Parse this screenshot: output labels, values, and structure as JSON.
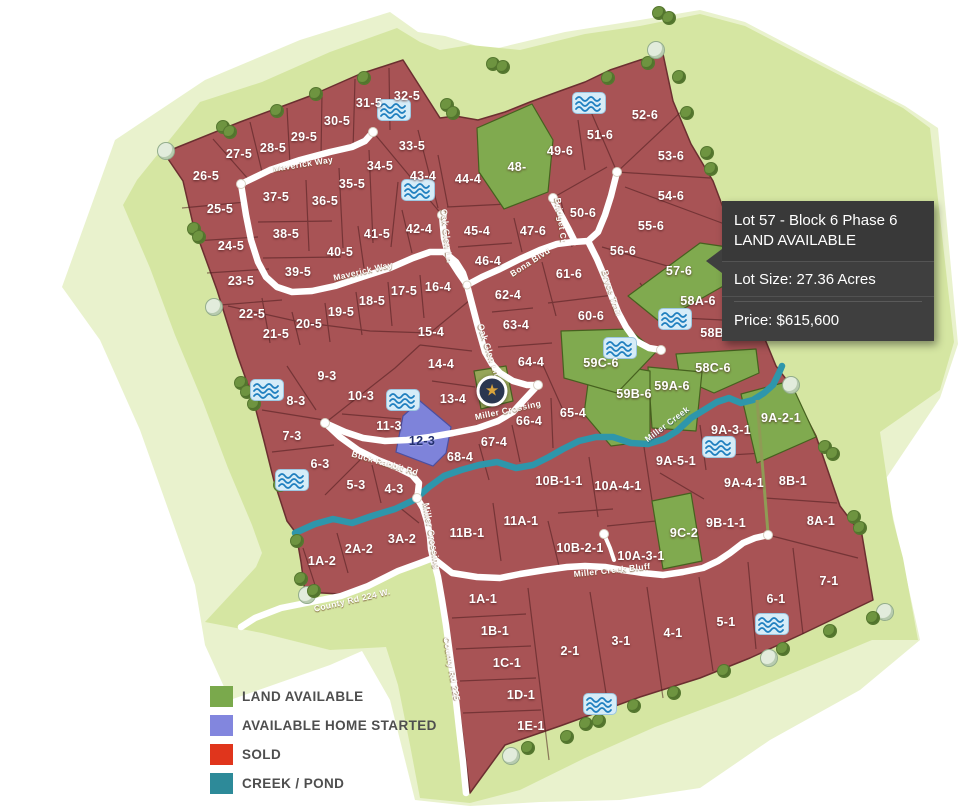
{
  "colors": {
    "sold": "#a85355",
    "available": "#80aa4f",
    "home_started": "#7e83da",
    "creek": "#2e96ab",
    "band_inner": "#d5e6a2",
    "band_outer": "#e9f2cd",
    "road": "#ffffff",
    "lot_border": "#5e2d2f",
    "legend_available": "#7aa94c",
    "legend_home_started": "#8286de",
    "legend_sold": "#e0351c",
    "legend_creek": "#2d8a99"
  },
  "tooltip": {
    "title": "Lot 57 - Block 6  Phase 6",
    "status": "LAND AVAILABLE",
    "lot_size": "Lot Size: 27.36 Acres",
    "price": "Price: $615,600"
  },
  "legend": {
    "items": [
      {
        "label": "LAND AVAILABLE",
        "color": "#7aa94c"
      },
      {
        "label": "AVAILABLE HOME STARTED",
        "color": "#8286de"
      },
      {
        "label": "SOLD",
        "color": "#e0351c"
      },
      {
        "label": "CREEK / POND",
        "color": "#2d8a99"
      }
    ]
  },
  "map": {
    "star": {
      "x": 492,
      "y": 391,
      "glyph": "★"
    },
    "creek_label": {
      "text": "Miller Creek",
      "x": 667,
      "y": 424,
      "angle": -37
    },
    "road_labels": [
      {
        "text": "Maverick Way",
        "x": 303,
        "y": 164,
        "angle": -9
      },
      {
        "text": "Maverick Way",
        "x": 363,
        "y": 271,
        "angle": -13
      },
      {
        "text": "Oak Glen Ln",
        "x": 447,
        "y": 236,
        "angle": 84
      },
      {
        "text": "Bona Blvd",
        "x": 530,
        "y": 262,
        "angle": -33
      },
      {
        "text": "Bridget Ct",
        "x": 561,
        "y": 220,
        "angle": 82
      },
      {
        "text": "Bryce Trail",
        "x": 612,
        "y": 293,
        "angle": 73
      },
      {
        "text": "Oak Glen Ln",
        "x": 489,
        "y": 350,
        "angle": 72
      },
      {
        "text": "Miller Crossing",
        "x": 508,
        "y": 410,
        "angle": -12
      },
      {
        "text": "Buck Rabbit Rd",
        "x": 385,
        "y": 463,
        "angle": 16
      },
      {
        "text": "Miller Crossing",
        "x": 432,
        "y": 536,
        "angle": 80
      },
      {
        "text": "Miller Creek Bluff",
        "x": 612,
        "y": 570,
        "angle": -6
      },
      {
        "text": "County Rd 224 W.",
        "x": 352,
        "y": 600,
        "angle": -13
      },
      {
        "text": "County Rd 225",
        "x": 452,
        "y": 669,
        "angle": 80
      }
    ],
    "ponds": [
      {
        "x": 394,
        "y": 110
      },
      {
        "x": 589,
        "y": 103
      },
      {
        "x": 418,
        "y": 190
      },
      {
        "x": 267,
        "y": 390
      },
      {
        "x": 403,
        "y": 400
      },
      {
        "x": 292,
        "y": 480
      },
      {
        "x": 675,
        "y": 319
      },
      {
        "x": 620,
        "y": 348
      },
      {
        "x": 719,
        "y": 447
      },
      {
        "x": 772,
        "y": 624
      },
      {
        "x": 600,
        "y": 704
      }
    ],
    "trees": [
      {
        "x": 165,
        "y": 150,
        "t": "pale"
      },
      {
        "x": 193,
        "y": 228,
        "t": "green"
      },
      {
        "x": 198,
        "y": 236,
        "t": "green"
      },
      {
        "x": 213,
        "y": 306,
        "t": "pale"
      },
      {
        "x": 240,
        "y": 382,
        "t": "green"
      },
      {
        "x": 246,
        "y": 391,
        "t": "green"
      },
      {
        "x": 253,
        "y": 403,
        "t": "green"
      },
      {
        "x": 279,
        "y": 484,
        "t": "green"
      },
      {
        "x": 296,
        "y": 540,
        "t": "green"
      },
      {
        "x": 300,
        "y": 578,
        "t": "green"
      },
      {
        "x": 306,
        "y": 594,
        "t": "pale"
      },
      {
        "x": 313,
        "y": 590,
        "t": "green"
      },
      {
        "x": 222,
        "y": 126,
        "t": "green"
      },
      {
        "x": 229,
        "y": 131,
        "t": "green"
      },
      {
        "x": 276,
        "y": 110,
        "t": "green"
      },
      {
        "x": 315,
        "y": 93,
        "t": "green"
      },
      {
        "x": 363,
        "y": 77,
        "t": "green"
      },
      {
        "x": 446,
        "y": 104,
        "t": "green"
      },
      {
        "x": 452,
        "y": 112,
        "t": "green"
      },
      {
        "x": 492,
        "y": 63,
        "t": "green"
      },
      {
        "x": 502,
        "y": 66,
        "t": "green"
      },
      {
        "x": 607,
        "y": 77,
        "t": "green"
      },
      {
        "x": 658,
        "y": 12,
        "t": "green"
      },
      {
        "x": 668,
        "y": 17,
        "t": "green"
      },
      {
        "x": 678,
        "y": 76,
        "t": "green"
      },
      {
        "x": 647,
        "y": 62,
        "t": "green"
      },
      {
        "x": 655,
        "y": 49,
        "t": "pale"
      },
      {
        "x": 686,
        "y": 112,
        "t": "green"
      },
      {
        "x": 706,
        "y": 152,
        "t": "green"
      },
      {
        "x": 710,
        "y": 168,
        "t": "green"
      },
      {
        "x": 824,
        "y": 446,
        "t": "green"
      },
      {
        "x": 832,
        "y": 453,
        "t": "green"
      },
      {
        "x": 853,
        "y": 516,
        "t": "green"
      },
      {
        "x": 859,
        "y": 527,
        "t": "green"
      },
      {
        "x": 790,
        "y": 384,
        "t": "pale"
      },
      {
        "x": 884,
        "y": 611,
        "t": "pale"
      },
      {
        "x": 872,
        "y": 617,
        "t": "green"
      },
      {
        "x": 829,
        "y": 630,
        "t": "green"
      },
      {
        "x": 768,
        "y": 657,
        "t": "pale"
      },
      {
        "x": 782,
        "y": 648,
        "t": "green"
      },
      {
        "x": 723,
        "y": 670,
        "t": "green"
      },
      {
        "x": 673,
        "y": 692,
        "t": "green"
      },
      {
        "x": 633,
        "y": 705,
        "t": "green"
      },
      {
        "x": 598,
        "y": 720,
        "t": "green"
      },
      {
        "x": 585,
        "y": 723,
        "t": "green"
      },
      {
        "x": 566,
        "y": 736,
        "t": "green"
      },
      {
        "x": 527,
        "y": 747,
        "t": "green"
      },
      {
        "x": 510,
        "y": 755,
        "t": "pale"
      }
    ],
    "lots": [
      {
        "id": "26-5",
        "x": 206,
        "y": 176,
        "status": "sold"
      },
      {
        "id": "27-5",
        "x": 239,
        "y": 154,
        "status": "sold"
      },
      {
        "id": "28-5",
        "x": 273,
        "y": 148,
        "status": "sold"
      },
      {
        "id": "29-5",
        "x": 304,
        "y": 137,
        "status": "sold"
      },
      {
        "id": "30-5",
        "x": 337,
        "y": 121,
        "status": "sold"
      },
      {
        "id": "31-5",
        "x": 369,
        "y": 103,
        "status": "sold"
      },
      {
        "id": "32-5",
        "x": 407,
        "y": 96,
        "status": "sold"
      },
      {
        "id": "33-5",
        "x": 412,
        "y": 146,
        "status": "sold"
      },
      {
        "id": "34-5",
        "x": 380,
        "y": 166,
        "status": "sold"
      },
      {
        "id": "35-5",
        "x": 352,
        "y": 184,
        "status": "sold"
      },
      {
        "id": "36-5",
        "x": 325,
        "y": 201,
        "status": "sold"
      },
      {
        "id": "37-5",
        "x": 276,
        "y": 197,
        "status": "sold"
      },
      {
        "id": "38-5",
        "x": 286,
        "y": 234,
        "status": "sold"
      },
      {
        "id": "39-5",
        "x": 298,
        "y": 272,
        "status": "sold"
      },
      {
        "id": "40-5",
        "x": 340,
        "y": 252,
        "status": "sold"
      },
      {
        "id": "41-5",
        "x": 377,
        "y": 234,
        "status": "sold"
      },
      {
        "id": "25-5",
        "x": 220,
        "y": 209,
        "status": "sold"
      },
      {
        "id": "24-5",
        "x": 231,
        "y": 246,
        "status": "sold"
      },
      {
        "id": "23-5",
        "x": 241,
        "y": 281,
        "status": "sold"
      },
      {
        "id": "22-5",
        "x": 252,
        "y": 314,
        "status": "sold"
      },
      {
        "id": "21-5",
        "x": 276,
        "y": 334,
        "status": "sold"
      },
      {
        "id": "20-5",
        "x": 309,
        "y": 324,
        "status": "sold"
      },
      {
        "id": "19-5",
        "x": 341,
        "y": 312,
        "status": "sold"
      },
      {
        "id": "18-5",
        "x": 372,
        "y": 301,
        "status": "sold"
      },
      {
        "id": "17-5",
        "x": 404,
        "y": 291,
        "status": "sold"
      },
      {
        "id": "42-4",
        "x": 419,
        "y": 229,
        "status": "sold"
      },
      {
        "id": "43-4",
        "x": 423,
        "y": 176,
        "status": "sold"
      },
      {
        "id": "44-4",
        "x": 468,
        "y": 179,
        "status": "sold"
      },
      {
        "id": "45-4",
        "x": 477,
        "y": 231,
        "status": "sold"
      },
      {
        "id": "46-4",
        "x": 488,
        "y": 261,
        "status": "sold"
      },
      {
        "id": "16-4",
        "x": 438,
        "y": 287,
        "status": "sold"
      },
      {
        "id": "62-4",
        "x": 508,
        "y": 295,
        "status": "sold"
      },
      {
        "id": "63-4",
        "x": 516,
        "y": 325,
        "status": "sold"
      },
      {
        "id": "64-4",
        "x": 531,
        "y": 362,
        "status": "sold"
      },
      {
        "id": "15-4",
        "x": 431,
        "y": 332,
        "status": "sold"
      },
      {
        "id": "14-4",
        "x": 441,
        "y": 364,
        "status": "sold"
      },
      {
        "id": "13-4",
        "x": 453,
        "y": 399,
        "status": "sold"
      },
      {
        "id": "65-4",
        "x": 573,
        "y": 413,
        "status": "sold"
      },
      {
        "id": "66-4",
        "x": 529,
        "y": 421,
        "status": "sold"
      },
      {
        "id": "67-4",
        "x": 494,
        "y": 442,
        "status": "sold"
      },
      {
        "id": "68-4",
        "x": 460,
        "y": 457,
        "status": "sold"
      },
      {
        "id": "47-6",
        "x": 533,
        "y": 231,
        "status": "sold"
      },
      {
        "id": "48-",
        "x": 517,
        "y": 167,
        "status": "available"
      },
      {
        "id": "49-6",
        "x": 560,
        "y": 151,
        "status": "sold"
      },
      {
        "id": "50-6",
        "x": 583,
        "y": 213,
        "status": "sold"
      },
      {
        "id": "51-6",
        "x": 600,
        "y": 135,
        "status": "sold"
      },
      {
        "id": "52-6",
        "x": 645,
        "y": 115,
        "status": "sold"
      },
      {
        "id": "53-6",
        "x": 671,
        "y": 156,
        "status": "sold"
      },
      {
        "id": "54-6",
        "x": 671,
        "y": 196,
        "status": "sold"
      },
      {
        "id": "55-6",
        "x": 651,
        "y": 226,
        "status": "sold"
      },
      {
        "id": "56-6",
        "x": 623,
        "y": 251,
        "status": "sold"
      },
      {
        "id": "57-6",
        "x": 679,
        "y": 271,
        "status": "available"
      },
      {
        "id": "58A-6",
        "x": 698,
        "y": 301,
        "status": "sold"
      },
      {
        "id": "58B-6",
        "x": 718,
        "y": 333,
        "status": "sold"
      },
      {
        "id": "58C-6",
        "x": 713,
        "y": 368,
        "status": "available"
      },
      {
        "id": "59A-6",
        "x": 672,
        "y": 386,
        "status": "available"
      },
      {
        "id": "59B-6",
        "x": 634,
        "y": 394,
        "status": "available"
      },
      {
        "id": "59C-6",
        "x": 601,
        "y": 363,
        "status": "available"
      },
      {
        "id": "60-6",
        "x": 591,
        "y": 316,
        "status": "sold"
      },
      {
        "id": "61-6",
        "x": 569,
        "y": 274,
        "status": "sold"
      },
      {
        "id": "9-3",
        "x": 327,
        "y": 376,
        "status": "sold"
      },
      {
        "id": "10-3",
        "x": 361,
        "y": 396,
        "status": "sold"
      },
      {
        "id": "8-3",
        "x": 296,
        "y": 401,
        "status": "sold"
      },
      {
        "id": "7-3",
        "x": 292,
        "y": 436,
        "status": "sold"
      },
      {
        "id": "11-3",
        "x": 389,
        "y": 426,
        "status": "sold"
      },
      {
        "id": "12-3",
        "x": 422,
        "y": 441,
        "status": "home_started"
      },
      {
        "id": "6-3",
        "x": 320,
        "y": 464,
        "status": "sold"
      },
      {
        "id": "5-3",
        "x": 356,
        "y": 485,
        "status": "sold"
      },
      {
        "id": "4-3",
        "x": 394,
        "y": 489,
        "status": "sold"
      },
      {
        "id": "3A-2",
        "x": 402,
        "y": 539,
        "status": "sold"
      },
      {
        "id": "2A-2",
        "x": 359,
        "y": 549,
        "status": "sold"
      },
      {
        "id": "1A-2",
        "x": 322,
        "y": 561,
        "status": "sold"
      },
      {
        "id": "11B-1",
        "x": 467,
        "y": 533,
        "status": "sold"
      },
      {
        "id": "11A-1",
        "x": 521,
        "y": 521,
        "status": "sold"
      },
      {
        "id": "10B-1-1",
        "x": 559,
        "y": 481,
        "status": "sold"
      },
      {
        "id": "10B-2-1",
        "x": 580,
        "y": 548,
        "status": "sold"
      },
      {
        "id": "10A-4-1",
        "x": 618,
        "y": 486,
        "status": "sold"
      },
      {
        "id": "10A-3-1",
        "x": 641,
        "y": 556,
        "status": "sold"
      },
      {
        "id": "9A-5-1",
        "x": 676,
        "y": 461,
        "status": "sold"
      },
      {
        "id": "9A-3-1",
        "x": 731,
        "y": 430,
        "status": "sold"
      },
      {
        "id": "9A-2-1",
        "x": 781,
        "y": 418,
        "status": "available"
      },
      {
        "id": "9A-4-1",
        "x": 744,
        "y": 483,
        "status": "sold"
      },
      {
        "id": "9B-1-1",
        "x": 726,
        "y": 523,
        "status": "sold"
      },
      {
        "id": "9C-2",
        "x": 684,
        "y": 533,
        "status": "available"
      },
      {
        "id": "8B-1",
        "x": 793,
        "y": 481,
        "status": "sold"
      },
      {
        "id": "8A-1",
        "x": 821,
        "y": 521,
        "status": "sold"
      },
      {
        "id": "7-1",
        "x": 829,
        "y": 581,
        "status": "sold"
      },
      {
        "id": "6-1",
        "x": 776,
        "y": 599,
        "status": "sold"
      },
      {
        "id": "5-1",
        "x": 726,
        "y": 622,
        "status": "sold"
      },
      {
        "id": "4-1",
        "x": 673,
        "y": 633,
        "status": "sold"
      },
      {
        "id": "3-1",
        "x": 621,
        "y": 641,
        "status": "sold"
      },
      {
        "id": "2-1",
        "x": 570,
        "y": 651,
        "status": "sold"
      },
      {
        "id": "1A-1",
        "x": 483,
        "y": 599,
        "status": "sold"
      },
      {
        "id": "1B-1",
        "x": 495,
        "y": 631,
        "status": "sold"
      },
      {
        "id": "1C-1",
        "x": 507,
        "y": 663,
        "status": "sold"
      },
      {
        "id": "1D-1",
        "x": 521,
        "y": 695,
        "status": "sold"
      },
      {
        "id": "1E-1",
        "x": 531,
        "y": 726,
        "status": "sold"
      }
    ]
  }
}
